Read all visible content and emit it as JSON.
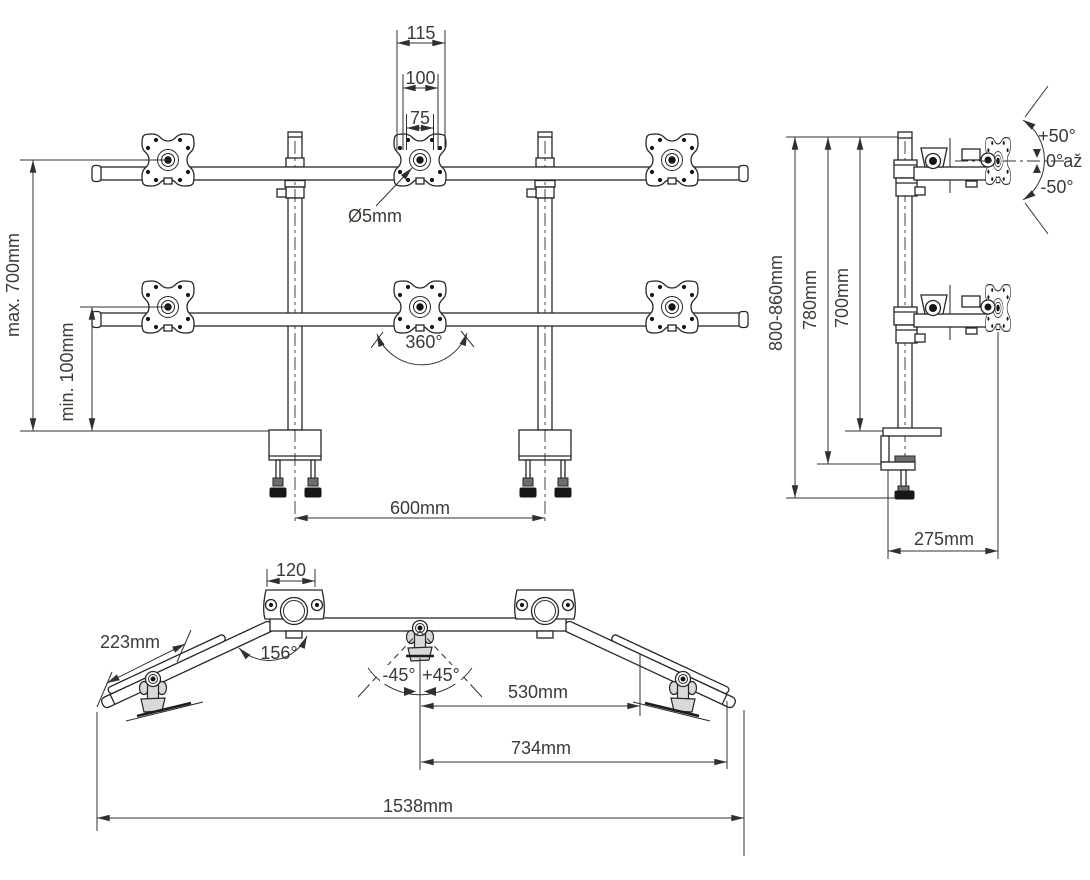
{
  "front_view": {
    "vesa_width_115": "115",
    "vesa_width_100": "100",
    "vesa_width_75": "75",
    "hole_diameter": "Ø5mm",
    "max_height": "max. 700mm",
    "min_height": "min. 100mm",
    "rotation_range": "360°",
    "pole_spacing": "600mm"
  },
  "side_view": {
    "tilt_up": "+50°",
    "tilt_zero": "0°až",
    "tilt_down": "-50°",
    "overall_height": "800-860mm",
    "height_to_clamp": "780mm",
    "height_above_desk": "700mm",
    "depth": "275mm"
  },
  "top_view": {
    "clamp_width": "120",
    "side_arm_length": "223mm",
    "bend_angle": "156°",
    "swivel_left": "-45°",
    "swivel_right": "+45°",
    "center_to_pivot": "530mm",
    "center_to_arm_end": "734mm",
    "overall_width": "1538mm"
  },
  "colors": {
    "line": "#262626",
    "text": "#3b3b34",
    "background": "#ffffff"
  }
}
